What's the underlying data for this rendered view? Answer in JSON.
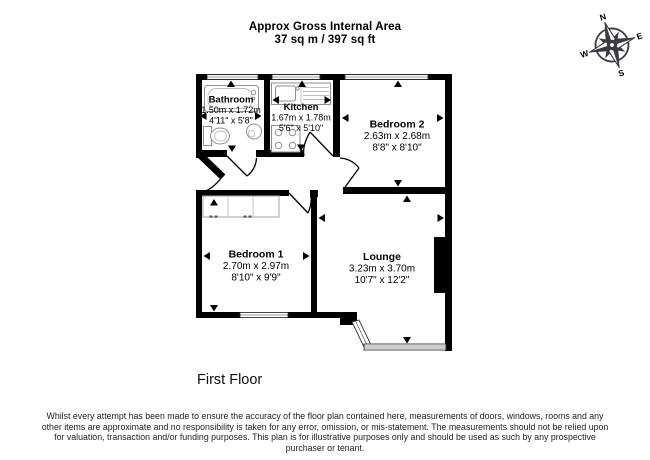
{
  "header": {
    "title_line1": "Approx Gross Internal Area",
    "title_line2": "37 sq m / 397 sq ft"
  },
  "floor_label": "First Floor",
  "compass": {
    "north": "N",
    "east": "E",
    "south": "S",
    "west": "W",
    "color": "#3b3b43"
  },
  "rooms": [
    {
      "name": "Bathroom",
      "metric": "1.50m x 1.72m",
      "imperial": "4'11\" x 5'8\""
    },
    {
      "name": "Kitchen",
      "metric": "1.67m x 1.78m",
      "imperial": "5'6\" x 5'10\""
    },
    {
      "name": "Bedroom 2",
      "metric": "2.63m x 2.68m",
      "imperial": "8'8\" x 8'10\""
    },
    {
      "name": "Bedroom 1",
      "metric": "2.70m x 2.97m",
      "imperial": "8'10\" x 9'9\""
    },
    {
      "name": "Lounge",
      "metric": "3.23m x 3.70m",
      "imperial": "10'7\" x 12'2\""
    }
  ],
  "disclaimer": "Whilst every attempt has been made to ensure the accuracy of the floor plan contained here, measurements of doors, windows, rooms and any other items are approximate and no responsibility is taken for any error, omission, or mis-statement. The measurements should not be relied upon for valuation, transaction and/or funding purposes. This plan is for illustrative purposes only and should be used as such by any prospective purchaser or tenant."
}
